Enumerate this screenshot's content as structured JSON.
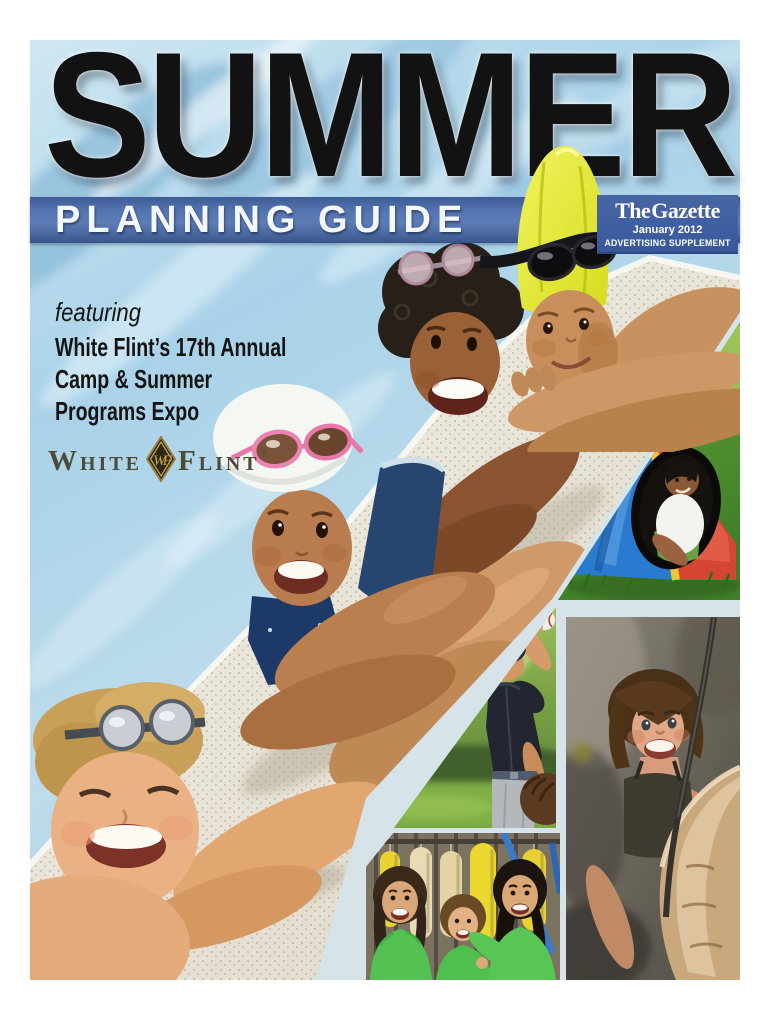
{
  "cover": {
    "title": "SUMMER",
    "banner_label": "PLANNING GUIDE",
    "masthead": {
      "name": "The Gazette",
      "issue": "January 2012",
      "supplement": "ADVERTISING SUPPLEMENT"
    },
    "feature": {
      "kicker": "featuring",
      "line1": "White Flint’s 17th Annual",
      "line2": "Camp & Summer",
      "line3": "Programs Expo"
    },
    "sponsor": {
      "word1": "White",
      "word2": "Flint",
      "monogram": "WF",
      "registered": "®"
    },
    "colors": {
      "banner_blue": "#4a69a6",
      "masthead_blue": "#3f5fa4",
      "collage_gap": "#d6e4ea",
      "title_ink": "#121212",
      "logo_olive": "#4c4a36",
      "shirt_green": "#54c253",
      "cap_yellow": "#e3e83e",
      "water_blue": "#a9d2e8"
    },
    "photos": {
      "pool": "Four smiling children in swim caps and goggles leaning on a pool edge",
      "tent": "Boy peeking out of a red, blue and yellow play tent on grass",
      "baseball": "Young baseball player in dark jersey throwing a ball",
      "climber": "Smiling woman rock climbing with a rope",
      "camp_kids": "Three girls in green camp T-shirts in front of hanging paddles"
    }
  }
}
